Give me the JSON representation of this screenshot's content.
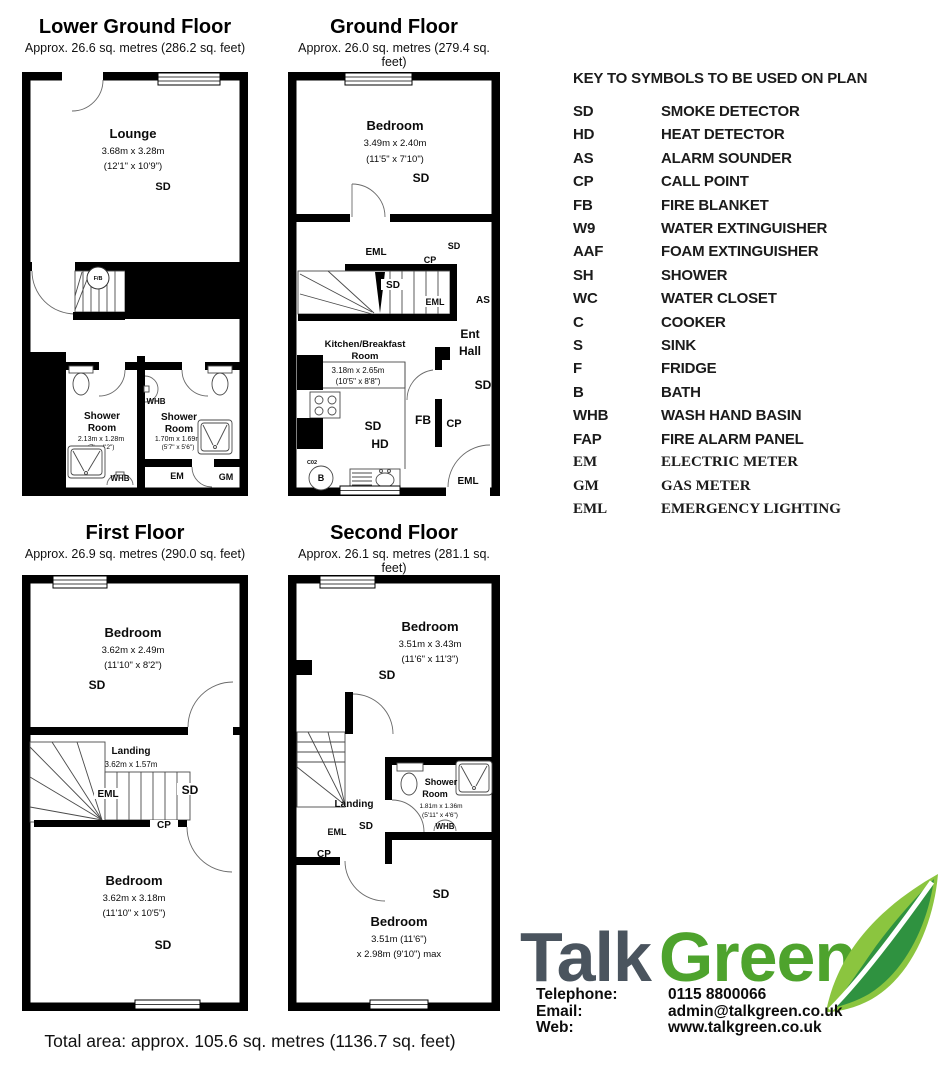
{
  "floors": {
    "lgf": {
      "title": "Lower Ground Floor",
      "subtitle": "Approx. 26.6 sq. metres (286.2 sq. feet)",
      "lounge": {
        "name": "Lounge",
        "m": "3.68m x 3.28m",
        "ft": "(12'1\" x 10'9\")",
        "sd": "SD"
      },
      "stairs_fb": "F/B",
      "shower1": {
        "l1": "Shower",
        "l2": "Room",
        "m": "2.13m x 1.28m",
        "ft": "(7' x 4'2\")",
        "whb": "WHB"
      },
      "whb_mid": "WHB",
      "shower2": {
        "l1": "Shower",
        "l2": "Room",
        "m": "1.70m x 1.69m",
        "ft": "(5'7\" x 5'6\")"
      },
      "em": "EM",
      "gm": "GM"
    },
    "gf": {
      "title": "Ground Floor",
      "subtitle": "Approx. 26.0 sq. metres (279.4 sq. feet)",
      "bedroom": {
        "name": "Bedroom",
        "m": "3.49m x 2.40m",
        "ft": "(11'5\" x 7'10\")",
        "sd": "SD"
      },
      "corridor": {
        "eml": "EML",
        "sd": "SD",
        "cp": "CP"
      },
      "stairs": {
        "sd": "SD",
        "eml": "EML"
      },
      "as": "AS",
      "ent": {
        "l1": "Ent",
        "l2": "Hall",
        "sd": "SD"
      },
      "kitchen": {
        "l1": "Kitchen/Breakfast",
        "l2": "Room",
        "m": "3.18m x 2.65m",
        "ft": "(10'5\" x 8'8\")",
        "sd": "SD",
        "hd": "HD",
        "fb": "FB",
        "cp": "CP",
        "c02": "C02",
        "b": "B",
        "s": "S",
        "eml": "EML"
      }
    },
    "ff": {
      "title": "First Floor",
      "subtitle": "Approx. 26.9 sq. metres (290.0 sq. feet)",
      "bedroom1": {
        "name": "Bedroom",
        "m": "3.62m x 2.49m",
        "ft": "(11'10\" x 8'2\")",
        "sd": "SD"
      },
      "landing": {
        "name": "Landing",
        "m": "3.62m x 1.57m",
        "ft": "(11'10\" x 5'2\")",
        "eml": "EML",
        "sd": "SD",
        "cp": "CP"
      },
      "bedroom2": {
        "name": "Bedroom",
        "m": "3.62m x 3.18m",
        "ft": "(11'10\" x 10'5\")",
        "sd": "SD"
      }
    },
    "sf": {
      "title": "Second Floor",
      "subtitle": "Approx. 26.1 sq. metres (281.1 sq. feet)",
      "bedroom1": {
        "name": "Bedroom",
        "m": "3.51m x 3.43m",
        "ft": "(11'6\" x 11'3\")",
        "sd": "SD"
      },
      "landing": {
        "name": "Landing",
        "sd": "SD",
        "eml": "EML",
        "cp": "CP"
      },
      "shower": {
        "l1": "Shower",
        "l2": "Room",
        "m": "1.81m x 1.36m",
        "ft": "(5'11\" x 4'6\")",
        "whb": "WHB"
      },
      "bedroom2": {
        "name": "Bedroom",
        "m": "3.51m (11'6\")",
        "ft": "x 2.98m (9'10\") max",
        "sd": "SD"
      }
    }
  },
  "key": {
    "title": "KEY TO SYMBOLS TO BE USED ON PLAN",
    "entries": [
      {
        "code": "SD",
        "label": "SMOKE DETECTOR"
      },
      {
        "code": "HD",
        "label": "HEAT DETECTOR"
      },
      {
        "code": "AS",
        "label": "ALARM SOUNDER"
      },
      {
        "code": "CP",
        "label": "CALL POINT"
      },
      {
        "code": "FB",
        "label": "FIRE BLANKET"
      },
      {
        "code": "W9",
        "label": "WATER EXTINGUISHER"
      },
      {
        "code": "AAF",
        "label": "FOAM EXTINGUISHER"
      },
      {
        "code": "SH",
        "label": "SHOWER"
      },
      {
        "code": "WC",
        "label": "WATER CLOSET"
      },
      {
        "code": "C",
        "label": "COOKER"
      },
      {
        "code": "S",
        "label": "SINK"
      },
      {
        "code": "F",
        "label": "FRIDGE"
      },
      {
        "code": "B",
        "label": "BATH"
      },
      {
        "code": "WHB",
        "label": "WASH HAND BASIN"
      },
      {
        "code": "FAP",
        "label": "FIRE ALARM PANEL"
      },
      {
        "code": "EM",
        "label": "ELECTRIC METER"
      },
      {
        "code": "GM",
        "label": "GAS METER"
      },
      {
        "code": "EML",
        "label": "EMERGENCY LIGHTING"
      }
    ]
  },
  "branding": {
    "talk": "Talk",
    "green": "Green",
    "colors": {
      "talk": "#4a545e",
      "green": "#4ea32d",
      "leaf_light": "#8bc53f",
      "leaf_dark": "#2f9240"
    },
    "contact_rows": [
      {
        "label": "Telephone:",
        "value": "0115 8800066"
      },
      {
        "label": "Email:",
        "value": "admin@talkgreen.co.uk"
      },
      {
        "label": "Web:",
        "value": "www.talkgreen.co.uk"
      }
    ]
  },
  "footer": {
    "total_area": "Total area: approx. 105.6 sq. metres (1136.7 sq. feet)"
  }
}
